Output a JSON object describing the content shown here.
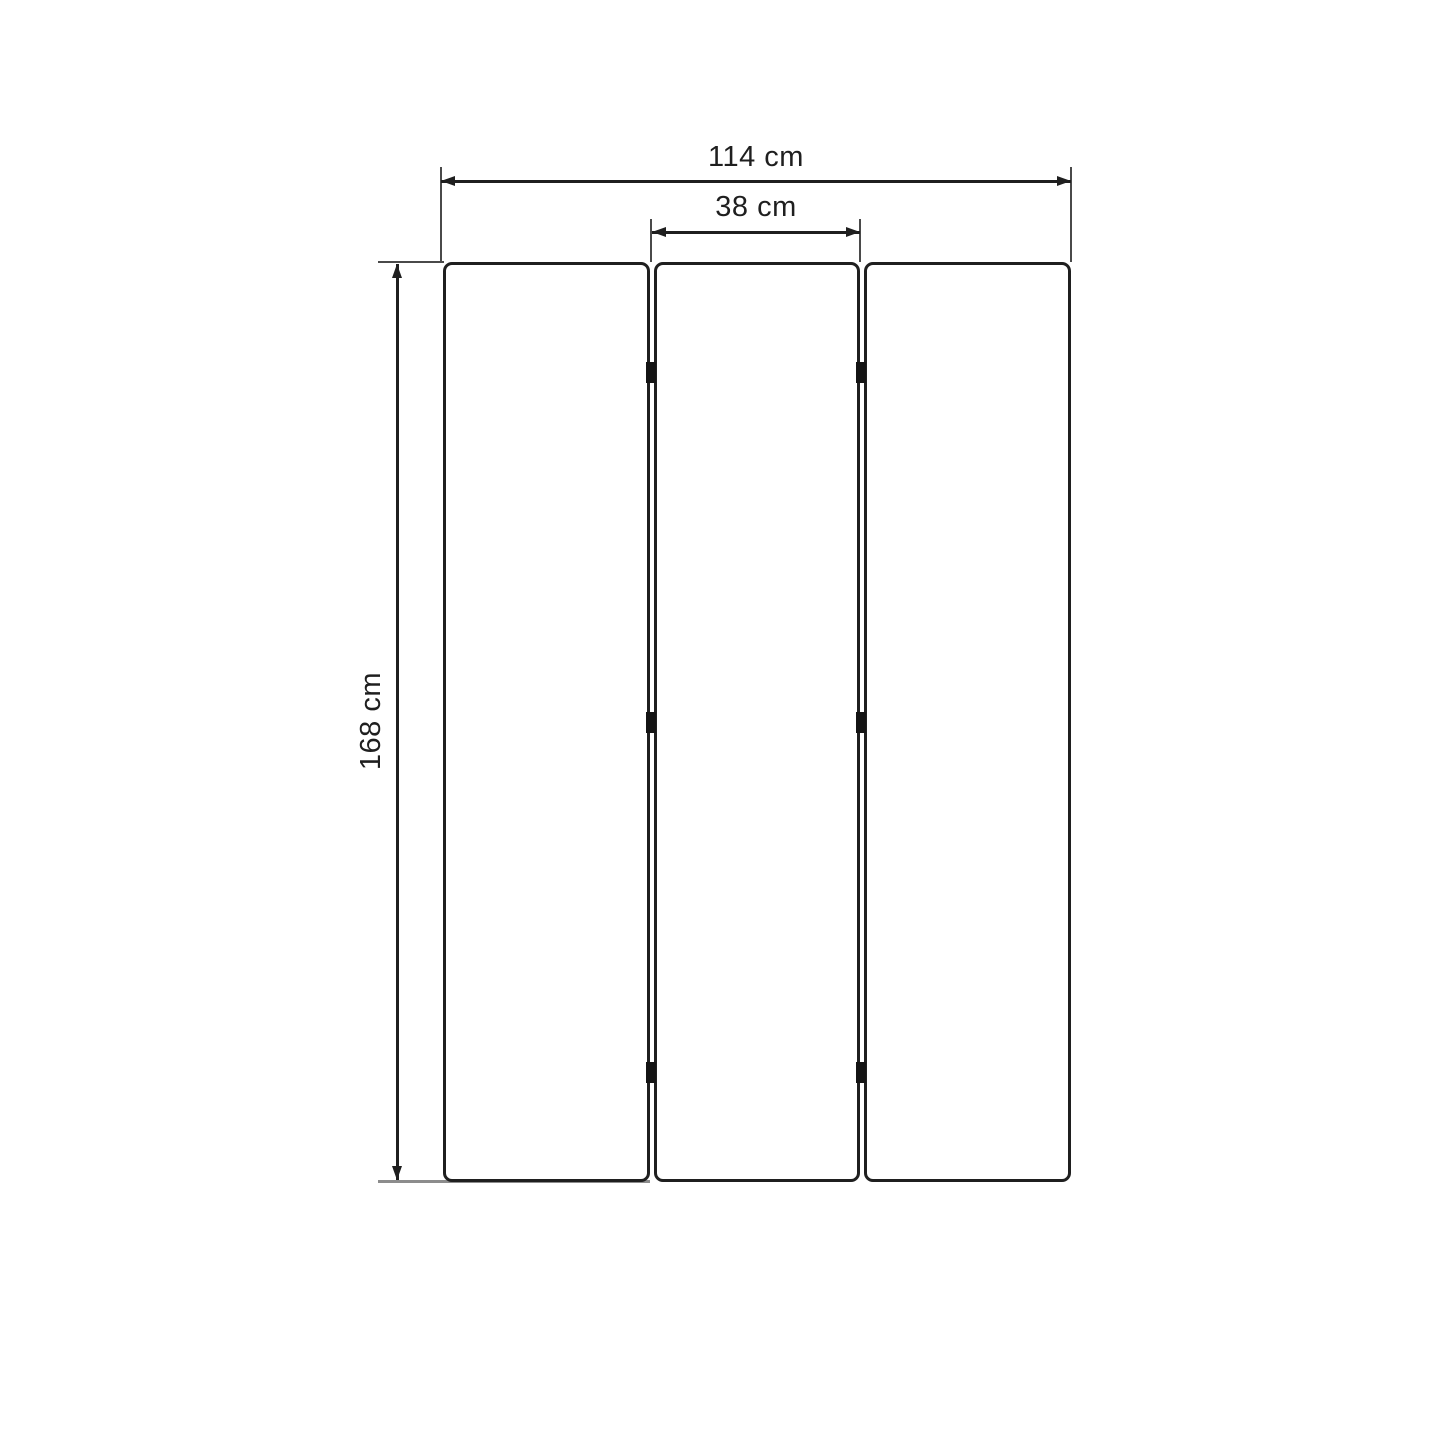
{
  "drawing": {
    "kind": "dimension-diagram",
    "panel_count": 3,
    "hinge_count": 6,
    "dimensions": {
      "overall_width": {
        "value": 114,
        "unit": "cm",
        "label": "114 cm"
      },
      "panel_width": {
        "value": 38,
        "unit": "cm",
        "label": "38 cm"
      },
      "height": {
        "value": 168,
        "unit": "cm",
        "label": "168 cm"
      }
    },
    "colors": {
      "background": "#ffffff",
      "panel_outline": "#1f1f1f",
      "dimension_line": "#1f1f1f",
      "extension_line": "#4a4a4a",
      "bottom_extension_line": "#8c8c8c",
      "hinge": "#141414"
    }
  }
}
